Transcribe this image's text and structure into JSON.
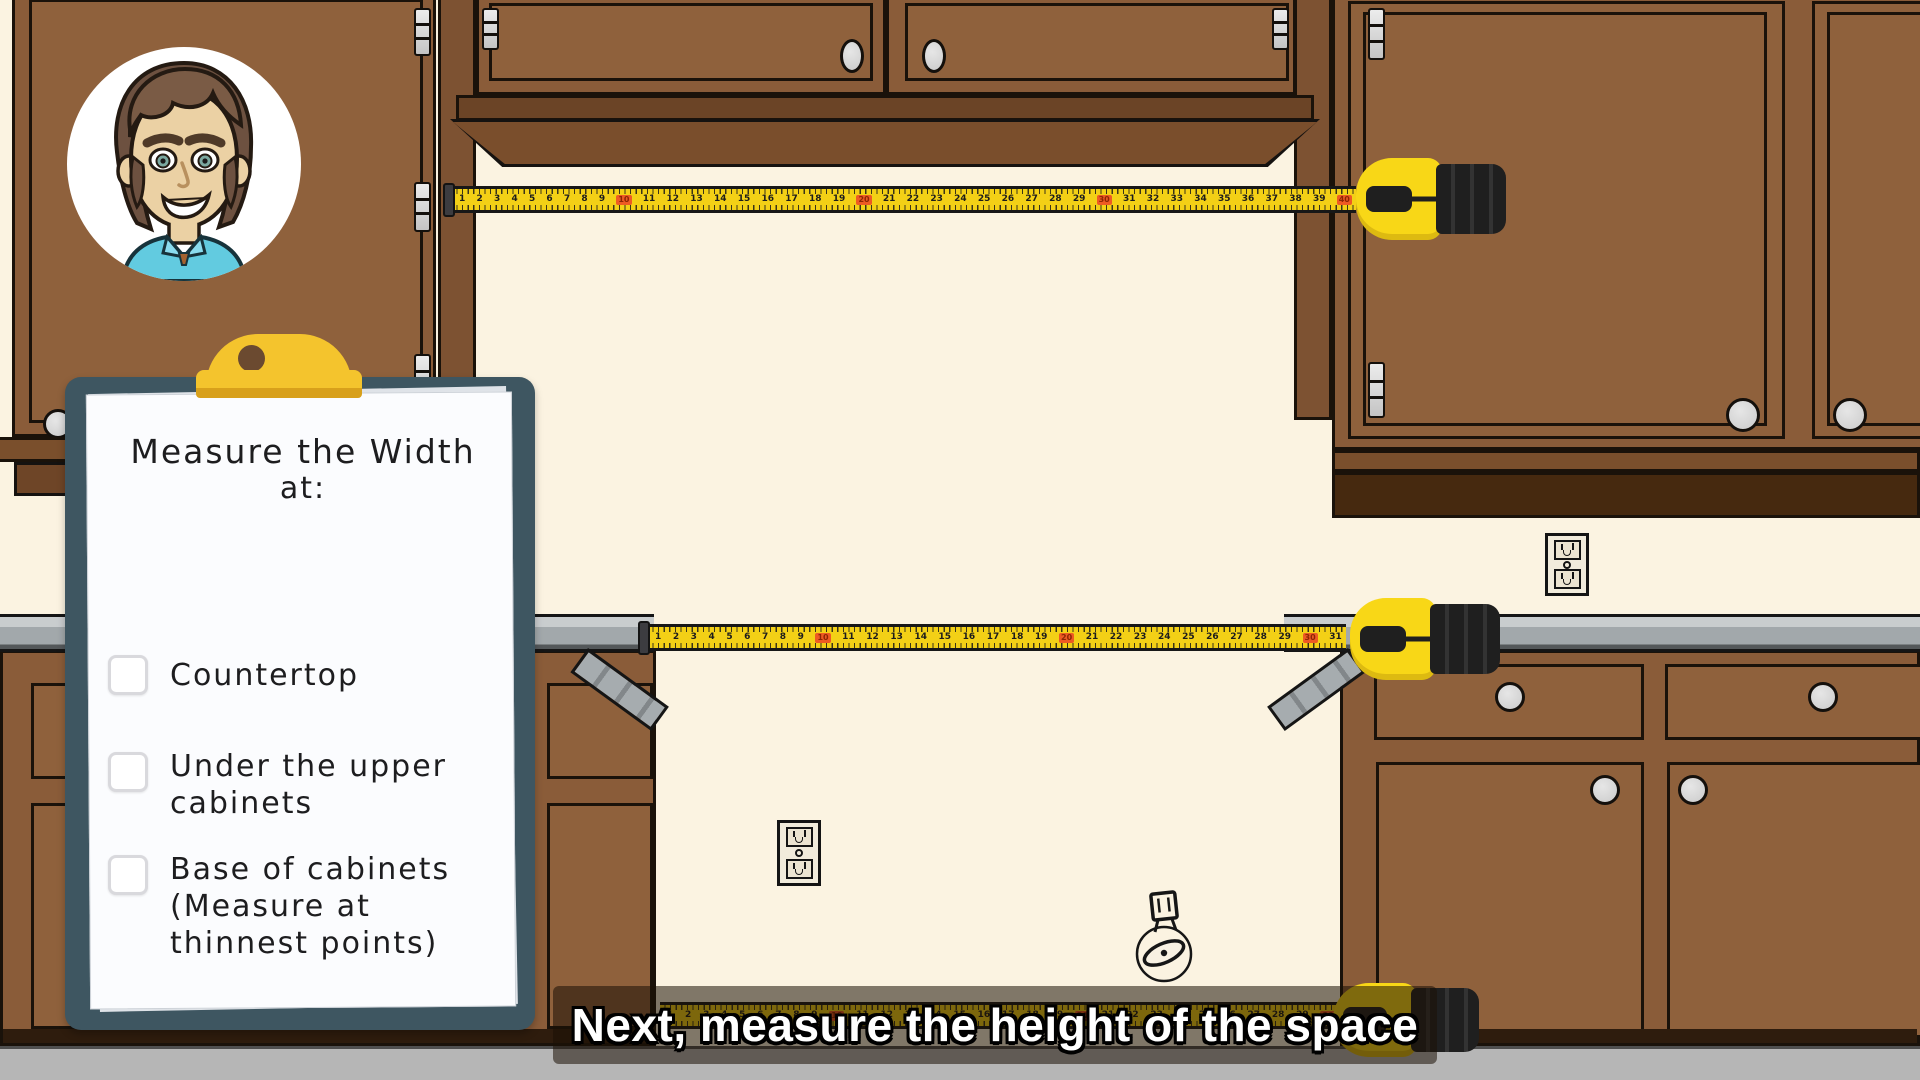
{
  "caption": {
    "text": "Next, measure the height of the space"
  },
  "clipboard": {
    "title_line1": "Measure the Width",
    "title_line2": "at:",
    "items": [
      {
        "checked": false,
        "label_lines": [
          "Countertop"
        ]
      },
      {
        "checked": false,
        "label_lines": [
          "Under the upper",
          "cabinets"
        ]
      },
      {
        "checked": false,
        "label_lines": [
          "Base of cabinets",
          "(Measure at",
          "thinnest points)"
        ]
      }
    ]
  },
  "tapes": {
    "top": {
      "first": 1,
      "last": 40,
      "decade_interval": 10
    },
    "middle": {
      "first": 1,
      "last": 31,
      "decade_interval": 10
    },
    "bottom": {
      "first": 1,
      "last": 30,
      "decade_interval": 10
    }
  },
  "icons": {
    "avatar": "presenter-avatar",
    "tape_measure": "yellow-tape-measure",
    "outlet": "duplex-power-outlet",
    "valve": "gas-valve-dial",
    "clip": "gold-clipboard-clip",
    "hinge": "cabinet-hinge",
    "knob": "cabinet-knob"
  },
  "colors": {
    "wall": "#fbf3e1",
    "cabinet_brown": "#8a5c39",
    "cabinet_dark": "#46290f",
    "countertop": "#a2a8ab",
    "floor": "#b6b6b6",
    "tape_yellow": "#f3d016",
    "tape_decade_orange": "#ee5a23",
    "clip_gold": "#f4c42d",
    "board_slate": "#3e5661",
    "caption_text": "#ffffff",
    "shirt_blue": "#62cbe0"
  }
}
